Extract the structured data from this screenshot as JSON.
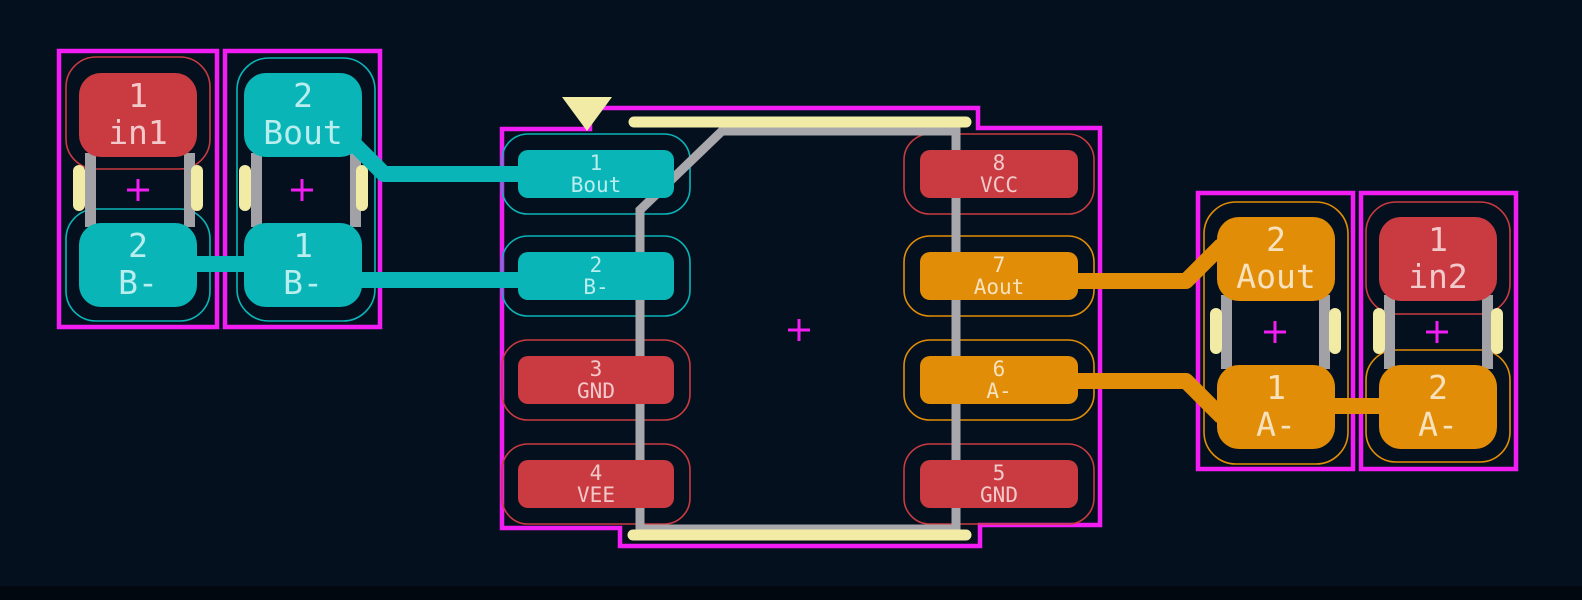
{
  "canvas": {
    "type": "pcb-layout-editor",
    "background_color": "#05101f",
    "anchor_marker_symbol": "+",
    "pin1_marker": "down-triangle"
  },
  "colors": {
    "courtyard_magenta": "#f21df2",
    "net_class_b_cyan": "#0ab5b8",
    "net_class_power_red": "#c93b40",
    "net_class_a_orange": "#e18d07",
    "silkscreen_yellow": "#f1eba6",
    "fab_gray": "#a8a8ac"
  },
  "ic": {
    "left_pads": [
      {
        "number": "1",
        "net": "Bout"
      },
      {
        "number": "2",
        "net": "B-"
      },
      {
        "number": "3",
        "net": "GND"
      },
      {
        "number": "4",
        "net": "VEE"
      }
    ],
    "right_pads": [
      {
        "number": "8",
        "net": "VCC"
      },
      {
        "number": "7",
        "net": "Aout"
      },
      {
        "number": "6",
        "net": "A-"
      },
      {
        "number": "5",
        "net": "GND"
      }
    ]
  },
  "components": [
    {
      "id": "left-outer",
      "pads": [
        {
          "number": "1",
          "net": "in1"
        },
        {
          "number": "2",
          "net": "B-"
        }
      ]
    },
    {
      "id": "left-inner",
      "pads": [
        {
          "number": "2",
          "net": "Bout"
        },
        {
          "number": "1",
          "net": "B-"
        }
      ]
    },
    {
      "id": "right-inner",
      "pads": [
        {
          "number": "2",
          "net": "Aout"
        },
        {
          "number": "1",
          "net": "A-"
        }
      ]
    },
    {
      "id": "right-outer",
      "pads": [
        {
          "number": "1",
          "net": "in2"
        },
        {
          "number": "2",
          "net": "A-"
        }
      ]
    }
  ]
}
